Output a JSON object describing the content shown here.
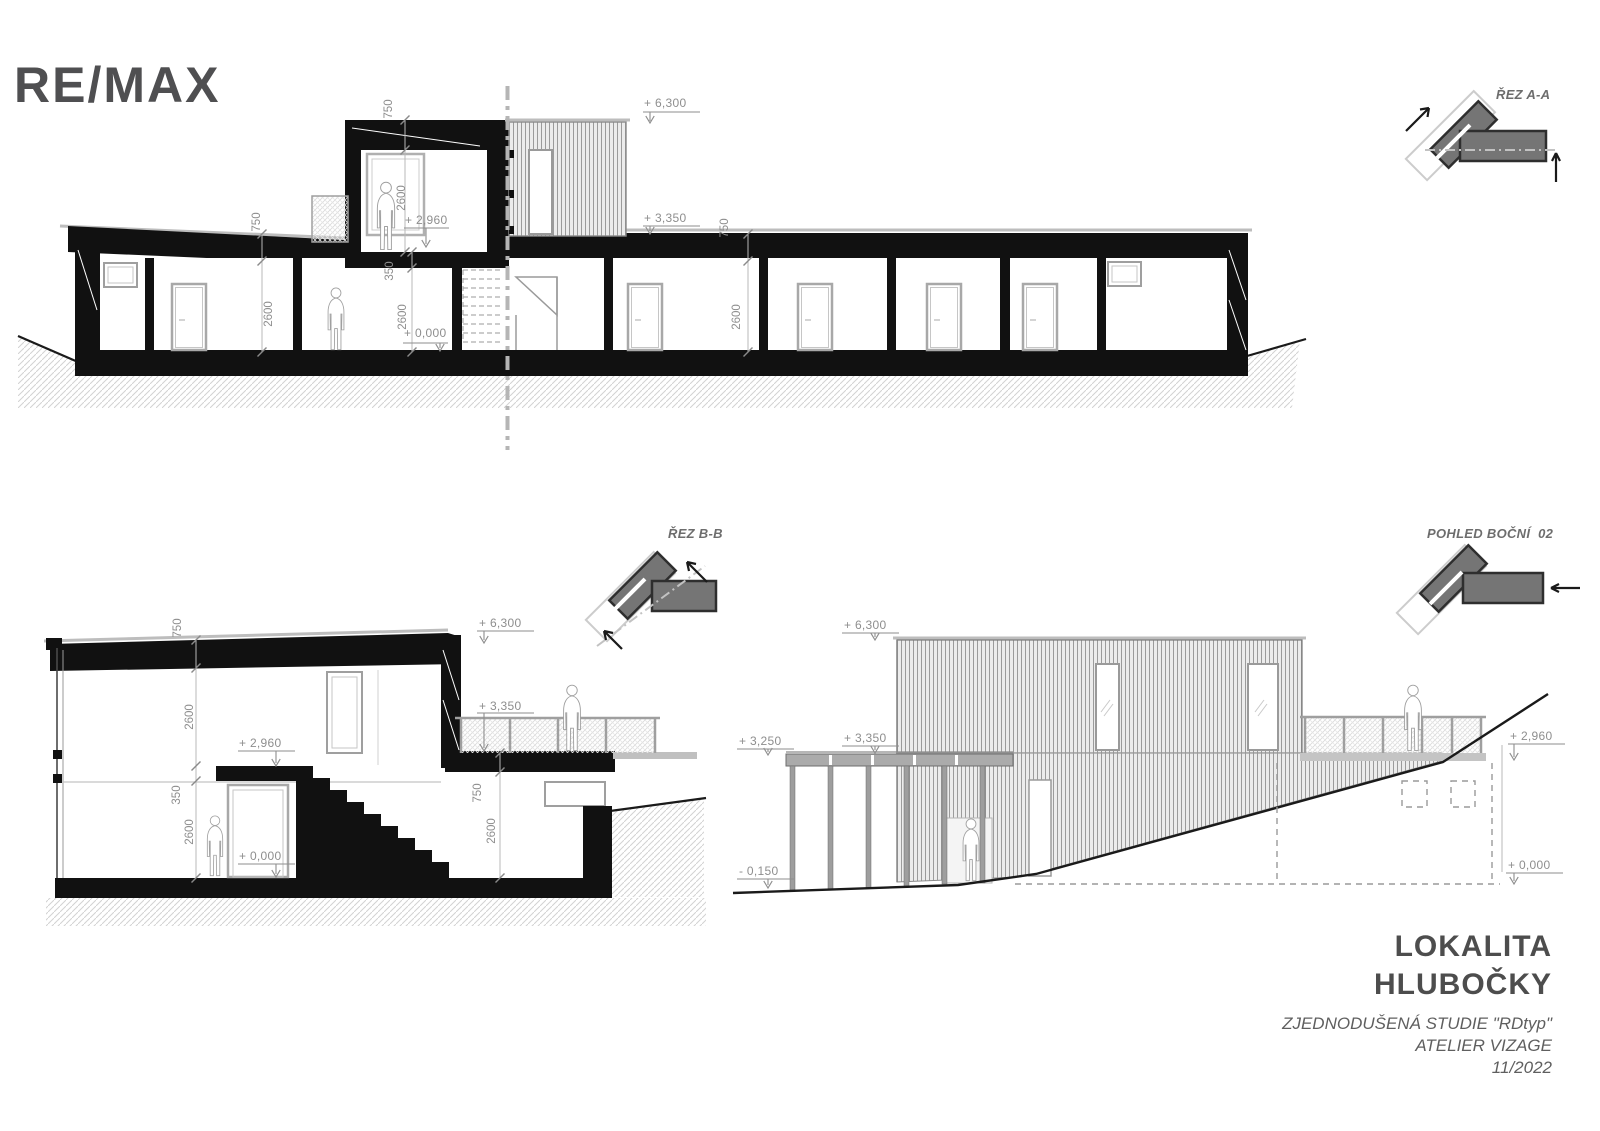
{
  "logo": {
    "text": "RE/MAX"
  },
  "views": {
    "rez_aa": {
      "label": "ŘEZ A-A"
    },
    "rez_bb": {
      "label": "ŘEZ B-B"
    },
    "pohled_bocni": {
      "label": "POHLED BOČNÍ  02"
    }
  },
  "levels": {
    "p6300": "+ 6,300",
    "p3350": "+ 3,350",
    "p3250": "+ 3,250",
    "p2960": "+ 2,960",
    "p0000": "+ 0,000",
    "m0150": "- 0,150"
  },
  "dims": {
    "d750": "750",
    "d2600": "2600",
    "d350": "350"
  },
  "title_block": {
    "location_line1": "LOKALITA",
    "location_line2": "HLUBOČKY",
    "study": "ZJEDNODUŠENÁ STUDIE \"RDtyp\"",
    "studio": "ATELIER VIZAGE",
    "date": "11/2022"
  },
  "colors": {
    "ink": "#111111",
    "annotation": "#8e8e8e",
    "logo_gray": "#4f4f51"
  }
}
